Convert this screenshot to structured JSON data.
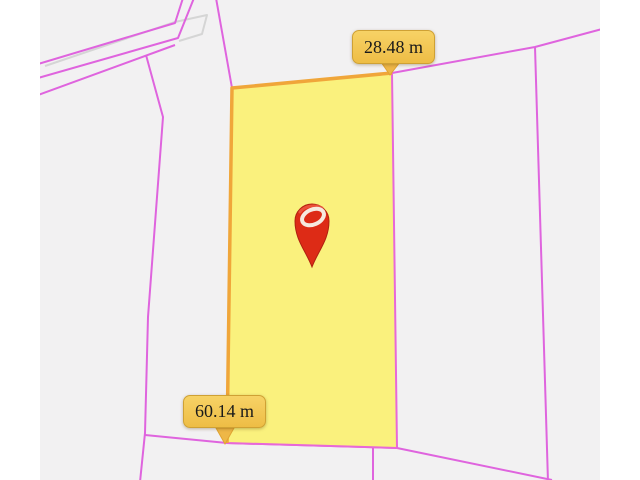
{
  "map": {
    "background_color": "#f2f1f2",
    "margin_color": "#ffffff",
    "boundary_line_color": "#df64de",
    "secondary_line_color": "#d5d5d5",
    "parcel": {
      "fill_color": "#fbf173",
      "outline_color": "#e868d8",
      "measured_edge_color": "#f0a63a"
    },
    "measurements": {
      "top_edge": "28.48 m",
      "left_edge": "60.14 m"
    },
    "measurement_label": {
      "background_color": "#f2c14d",
      "text_color": "#1a1a1a"
    },
    "marker": {
      "name": "location-pin",
      "color": "#dd2b16"
    }
  }
}
